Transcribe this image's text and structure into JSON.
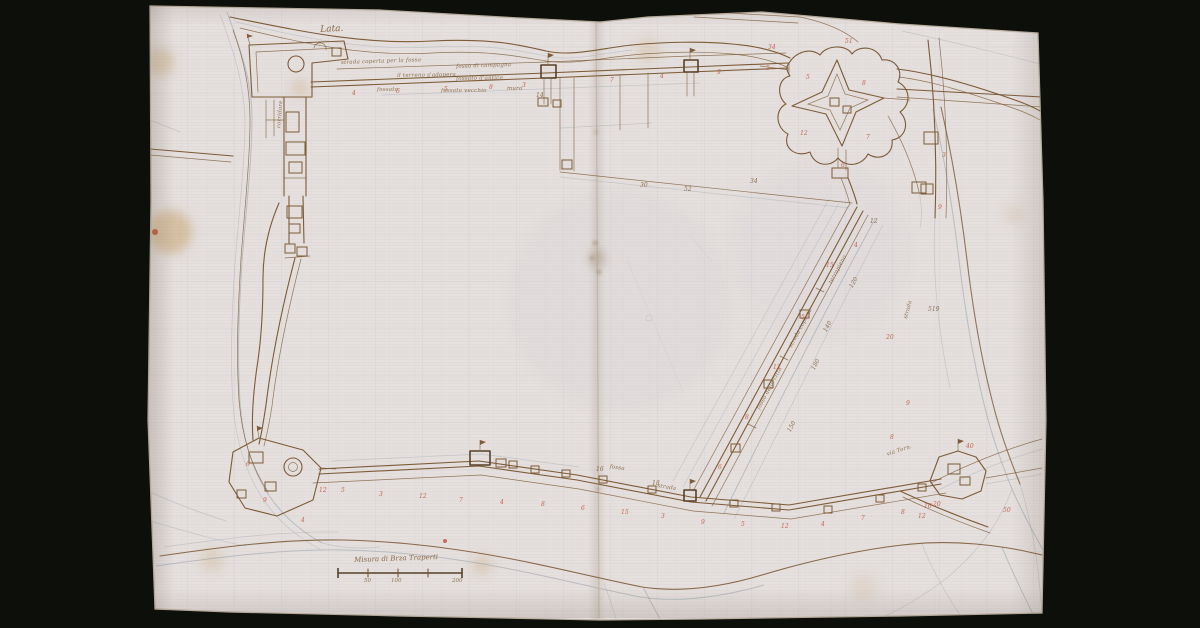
{
  "colors": {
    "background": "#0d0f0b",
    "paper": "#e5dfde",
    "ink": "#7c5b36",
    "ink_dark": "#57412a",
    "graphite": "#95a0a8",
    "chalk_red": "#c05038",
    "stain": "#c39a5c",
    "grid": "#8fa2b8",
    "fold": "#b1a188",
    "edge": "#b9ad9e"
  },
  "labels": {
    "river_name": "Lata."
  },
  "scale_bar": {
    "caption": "Misura di Brza Traperti",
    "unit_labels": [
      "50",
      "100",
      "200"
    ]
  },
  "annotations": [
    {
      "text": "strada coperta per la fossa",
      "x": 341,
      "y": 60,
      "rot": -2,
      "size": 5.5
    },
    {
      "text": "fosso di campagna",
      "x": 456,
      "y": 64,
      "rot": -2,
      "size": 5.5
    },
    {
      "text": "il terreno s'adopera",
      "x": 397,
      "y": 73,
      "rot": -1,
      "size": 5.5
    },
    {
      "text": "fossato d'antico",
      "x": 456,
      "y": 76,
      "rot": -1,
      "size": 5.5
    },
    {
      "text": "fossato",
      "x": 377,
      "y": 87,
      "rot": 0,
      "size": 5.5
    },
    {
      "text": "fossato vecchio",
      "x": 441,
      "y": 88,
      "rot": 0,
      "size": 5.5
    },
    {
      "text": "muro",
      "x": 507,
      "y": 86,
      "rot": 0,
      "size": 5.5
    },
    {
      "text": "terrapieno",
      "x": 828,
      "y": 282,
      "rot": -62,
      "size": 5.5
    },
    {
      "text": "strada coperta",
      "x": 788,
      "y": 346,
      "rot": -62,
      "size": 5.5
    },
    {
      "text": "fosso della citta",
      "x": 756,
      "y": 408,
      "rot": -62,
      "size": 5.5
    },
    {
      "text": "strada",
      "x": 903,
      "y": 318,
      "rot": -75,
      "size": 5.5
    },
    {
      "text": "via Torn.",
      "x": 886,
      "y": 452,
      "rot": -18,
      "size": 5.5
    },
    {
      "text": "fossa",
      "x": 610,
      "y": 464,
      "rot": 8,
      "size": 5.5
    },
    {
      "text": "strada",
      "x": 658,
      "y": 483,
      "rot": 10,
      "size": 5.5
    },
    {
      "text": "corridore",
      "x": 276,
      "y": 128,
      "rot": -85,
      "size": 5.5
    }
  ],
  "red_marks": [
    {
      "t": "4",
      "x": 352,
      "y": 90
    },
    {
      "t": "6",
      "x": 396,
      "y": 88
    },
    {
      "t": "5",
      "x": 444,
      "y": 86
    },
    {
      "t": "8",
      "x": 489,
      "y": 84
    },
    {
      "t": "3",
      "x": 522,
      "y": 82
    },
    {
      "t": "7",
      "x": 610,
      "y": 77
    },
    {
      "t": "4",
      "x": 660,
      "y": 73
    },
    {
      "t": "9",
      "x": 717,
      "y": 69
    },
    {
      "t": "5",
      "x": 766,
      "y": 65
    },
    {
      "t": "51",
      "x": 845,
      "y": 38
    },
    {
      "t": "34",
      "x": 768,
      "y": 44
    },
    {
      "t": "5",
      "x": 806,
      "y": 74
    },
    {
      "t": "8",
      "x": 862,
      "y": 80
    },
    {
      "t": "12",
      "x": 800,
      "y": 130
    },
    {
      "t": "7",
      "x": 866,
      "y": 134
    },
    {
      "t": "6",
      "x": 841,
      "y": 162
    },
    {
      "t": "3",
      "x": 942,
      "y": 152
    },
    {
      "t": "9",
      "x": 938,
      "y": 204
    },
    {
      "t": "15",
      "x": 826,
      "y": 262
    },
    {
      "t": "5",
      "x": 801,
      "y": 314
    },
    {
      "t": "12",
      "x": 773,
      "y": 364
    },
    {
      "t": "8",
      "x": 745,
      "y": 414
    },
    {
      "t": "6",
      "x": 718,
      "y": 464
    },
    {
      "t": "4",
      "x": 854,
      "y": 242
    },
    {
      "t": "20",
      "x": 886,
      "y": 334
    },
    {
      "t": "9",
      "x": 906,
      "y": 400
    },
    {
      "t": "5",
      "x": 341,
      "y": 487
    },
    {
      "t": "3",
      "x": 379,
      "y": 491
    },
    {
      "t": "12",
      "x": 419,
      "y": 493
    },
    {
      "t": "7",
      "x": 459,
      "y": 497
    },
    {
      "t": "4",
      "x": 500,
      "y": 499
    },
    {
      "t": "8",
      "x": 541,
      "y": 501
    },
    {
      "t": "6",
      "x": 581,
      "y": 505
    },
    {
      "t": "15",
      "x": 621,
      "y": 509
    },
    {
      "t": "3",
      "x": 661,
      "y": 513
    },
    {
      "t": "9",
      "x": 701,
      "y": 519
    },
    {
      "t": "5",
      "x": 741,
      "y": 521
    },
    {
      "t": "12",
      "x": 781,
      "y": 523
    },
    {
      "t": "4",
      "x": 821,
      "y": 521
    },
    {
      "t": "7",
      "x": 861,
      "y": 515
    },
    {
      "t": "8",
      "x": 901,
      "y": 509
    },
    {
      "t": "20",
      "x": 933,
      "y": 501
    },
    {
      "t": "6",
      "x": 246,
      "y": 461
    },
    {
      "t": "9",
      "x": 263,
      "y": 497
    },
    {
      "t": "4",
      "x": 301,
      "y": 517
    },
    {
      "t": "12",
      "x": 319,
      "y": 487
    },
    {
      "t": "50",
      "x": 1003,
      "y": 507
    },
    {
      "t": "16",
      "x": 924,
      "y": 503
    },
    {
      "t": "12",
      "x": 918,
      "y": 513
    },
    {
      "t": "40",
      "x": 966,
      "y": 443
    },
    {
      "t": "8",
      "x": 890,
      "y": 434
    }
  ],
  "ink_marks": [
    {
      "t": "519",
      "x": 928,
      "y": 306
    },
    {
      "t": "140",
      "x": 822,
      "y": 330,
      "rot": -62
    },
    {
      "t": "180",
      "x": 810,
      "y": 368,
      "rot": -62
    },
    {
      "t": "120",
      "x": 848,
      "y": 286,
      "rot": -62
    },
    {
      "t": "150",
      "x": 786,
      "y": 430,
      "rot": -62
    },
    {
      "t": "52",
      "x": 684,
      "y": 186
    },
    {
      "t": "30",
      "x": 640,
      "y": 182
    },
    {
      "t": "14",
      "x": 536,
      "y": 92
    },
    {
      "t": "16",
      "x": 596,
      "y": 466
    },
    {
      "t": "18",
      "x": 652,
      "y": 480
    },
    {
      "t": "34",
      "x": 750,
      "y": 178
    },
    {
      "t": "12",
      "x": 870,
      "y": 218
    }
  ]
}
